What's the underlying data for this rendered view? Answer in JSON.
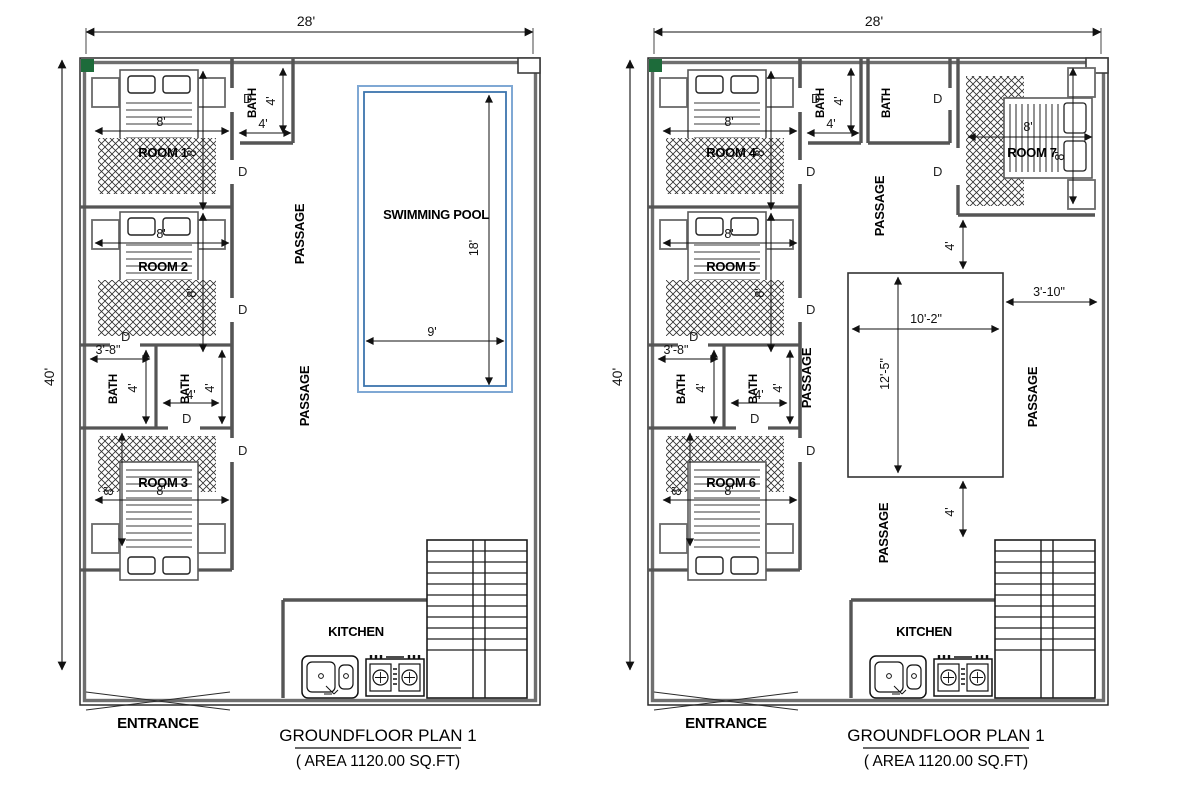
{
  "drawing": {
    "title": "GROUNDFLOOR PLAN 1",
    "area": "( AREA  1120.00 SQ.FT)",
    "entrance": "ENTRANCE",
    "kitchen": "KITCHEN",
    "bath": "BATH",
    "passage": "PASSAGE",
    "door": "D",
    "pool": "SWIMMING POOL"
  },
  "dims": {
    "plot_width": "28'",
    "plot_height": "40'",
    "bed": "8'",
    "four": "4'",
    "bath_width": "3'-8\"",
    "pool_width": "9'",
    "pool_length": "18'",
    "court_width": "10'-2\"",
    "court_height": "12'-5\"",
    "side_offset": "3'-10\""
  },
  "plan1": {
    "rooms": [
      "ROOM 1",
      "ROOM 2",
      "ROOM 3"
    ]
  },
  "plan2": {
    "rooms": [
      "ROOM 4",
      "ROOM 5",
      "ROOM 6",
      "ROOM 7"
    ]
  },
  "colors": {
    "wall": "#4a4a4a",
    "corner_marker": "#1d6b3a",
    "pool": "#3c74ad",
    "pool_light": "#7fa8d4"
  }
}
